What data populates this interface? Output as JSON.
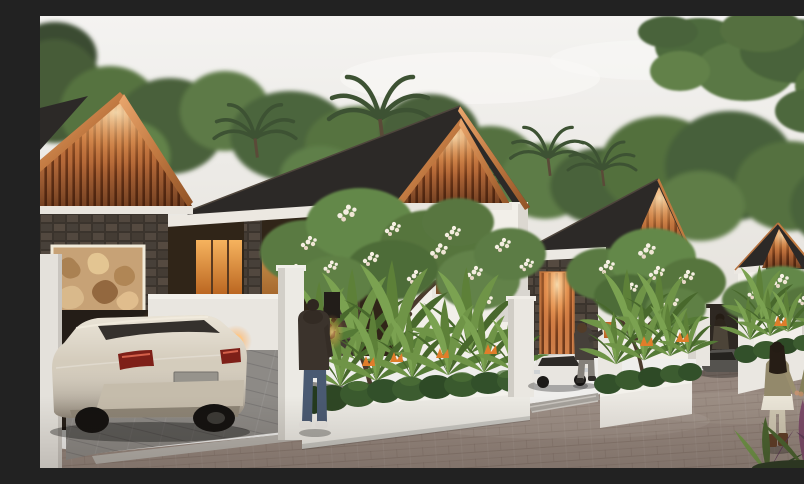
{
  "scene": {
    "description": "Dusk 3D architectural rendering of a row of modern tropical villas with glowing timber-slat gables, dark pitched roofs, lava-stone walls, a carved relief panel, lush frangipani and heliconia landscaping, a champagne hatchback parked in a carport, a small white car and a dark car in driveways, a man standing at a gate, a person at an entry pillar, a woman at a doorway, and a couple strolling along a paver street",
    "time_of_day": "dusk",
    "houses_visible": 5,
    "people_visible": 5,
    "vehicles_visible": 3
  },
  "palette": {
    "sky_top": "#f4f3f1",
    "sky_bottom": "#e7e4df",
    "foliage_dark": "#44593a",
    "foliage_mid": "#55713f",
    "foliage_light": "#6e8c4f",
    "roof_dark": "#2c2927",
    "copper_trim": "#c27a42",
    "gable_slat": "#cf7f49",
    "gable_glow": "#ffd9a8",
    "wall_white": "#f2efe9",
    "wall_shade": "#d8d4cd",
    "stone_dark": "#463e37",
    "carved_panel": "#c7a276",
    "window_glow": "#f0a04e",
    "hedge_green": "#33502a",
    "plant_green": "#6f9447",
    "flower_orange": "#e07d2a",
    "frangipani_white": "#f4eee1",
    "road_paver": "#96877e",
    "driveway_gray": "#8d8a86",
    "curb_light": "#b6b2ac",
    "car_champagne": "#d2c9b8",
    "car_white": "#e8e5e0",
    "taillight_red": "#7e2018",
    "denim_blue": "#4a5a72",
    "jacket_dark": "#3b332c",
    "shirt_olive": "#8a8560",
    "pants_cream": "#cfc7b2"
  }
}
